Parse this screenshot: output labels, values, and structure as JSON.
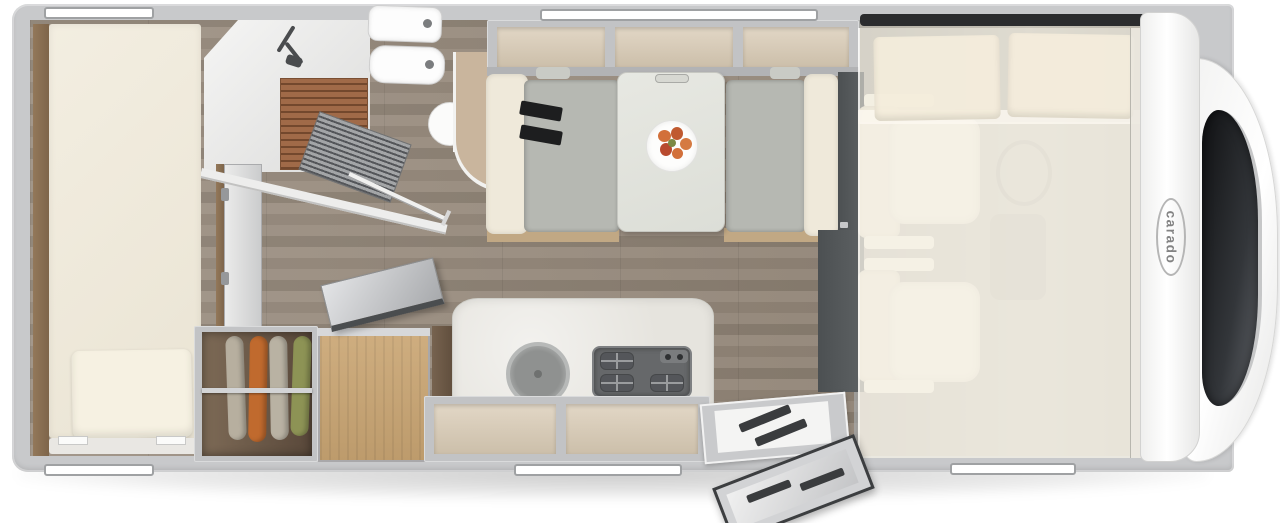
{
  "app": {
    "type": "floorplan-illustration",
    "title": "Motorhome top-view floor plan"
  },
  "brand": {
    "logo_text": "carado"
  },
  "palette": {
    "background": "#ffffff",
    "body_wall": "#c8c9cb",
    "front_cap": "#f6f6f5",
    "windshield": "#1b1d1f",
    "floor_wood": "#8f8274",
    "dark_wood": "#6d5a49",
    "oak_wood": "#c7a577",
    "mattress_cream": "#f0ebdd",
    "seat_gray": "#b6b8b2",
    "seat_cream": "#efe9da",
    "cabinet_beige": "#d9cdb9",
    "frame_gray": "#c2c3c5",
    "stove_gray": "#66686a",
    "shower_slats": "#a06a48",
    "garment_colors": [
      "#b7af9f",
      "#c06a2e",
      "#b9b2a3",
      "#8d9355"
    ]
  },
  "areas": {
    "rear_bed": "longitudinal rear bed with pillow",
    "bathroom": "shower with wooden grate, washbasin, toilet",
    "wardrobe": "open wardrobe with four hanging garments",
    "storage_chest": "oak storage chest with open lid",
    "kitchen": "kitchen block with round sink, hob and lower cabinets",
    "dinette": "face-to-face dinette with table and meal plate",
    "overhead_lockers": "overhead locker row with three compartments",
    "cab": "driver and passenger seats under drop-down bed",
    "drop_down_bed": "semi-transparent pull-down bed with two pillows",
    "entry": "entrance step with open entry door"
  },
  "counts": {
    "window_bars": 5,
    "overhead_compartments": 3,
    "wardrobe_garments": 4,
    "hob_burners": 3,
    "cab_seats": 2,
    "drop_down_bed_pillows": 2
  }
}
